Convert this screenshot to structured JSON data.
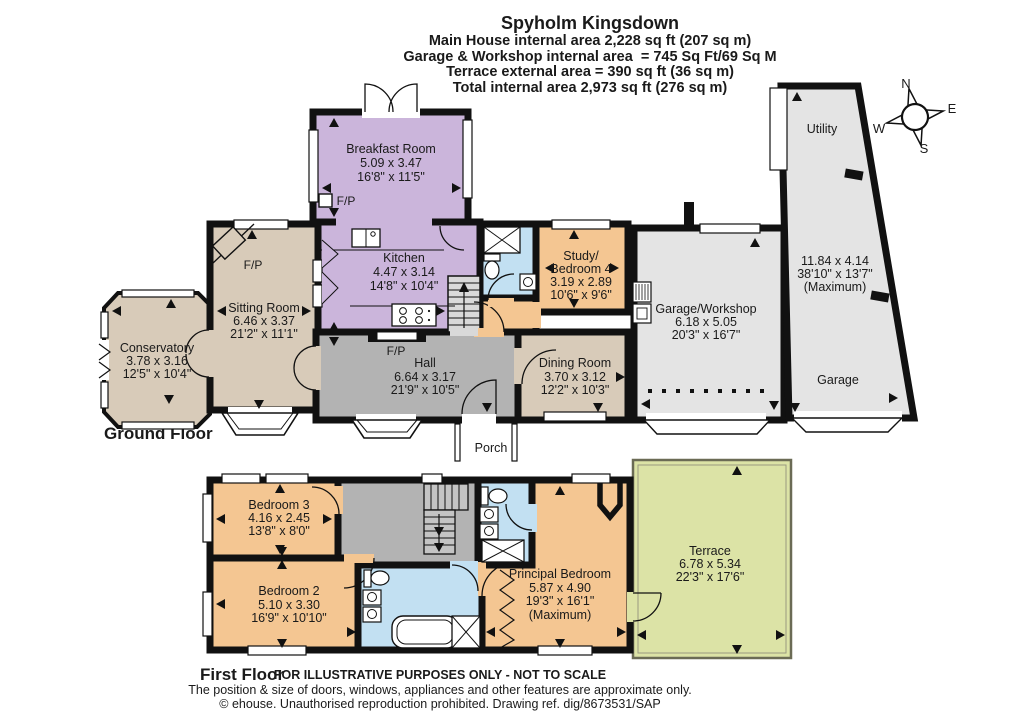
{
  "header": {
    "title": "Spyholm Kingsdown",
    "subtitle_lines": [
      "Main House internal area 2,228 sq ft (207 sq m)",
      "Garage & Workshop internal area  = 745 Sq Ft/69 Sq M",
      "Terrace external area = 390 sq ft (36 sq m)",
      "Total internal area 2,973 sq ft (276 sq m)"
    ]
  },
  "floor_labels": {
    "ground": "Ground Floor",
    "first": "First Floor"
  },
  "compass": {
    "north": "N",
    "east": "E",
    "south": "S",
    "west": "W"
  },
  "fireplace_label": "F/P",
  "rooms": {
    "breakfast_room": {
      "name": "Breakfast Room",
      "size_m": "5.09 x 3.47",
      "size_ft": "16'8\" x 11'5\""
    },
    "kitchen": {
      "name": "Kitchen",
      "size_m": "4.47 x 3.14",
      "size_ft": "14'8\" x 10'4\""
    },
    "study_bedroom4": {
      "name_line1": "Study/",
      "name_line2": "Bedroom 4",
      "size_m": "3.19 x 2.89",
      "size_ft": "10'6\" x 9'6\""
    },
    "sitting_room": {
      "name": "Sitting Room",
      "size_m": "6.46 x 3.37",
      "size_ft": "21'2\" x 11'1\""
    },
    "conservatory": {
      "name": "Conservatory",
      "size_m": "3.78 x 3.16",
      "size_ft": "12'5\" x 10'4\""
    },
    "hall": {
      "name": "Hall",
      "size_m": "6.64 x 3.17",
      "size_ft": "21'9\" x 10'5\""
    },
    "dining_room": {
      "name": "Dining Room",
      "size_m": "3.70 x 3.12",
      "size_ft": "12'2\" x 10'3\""
    },
    "garage_workshop": {
      "name": "Garage/Workshop",
      "size_m": "6.18 x 5.05",
      "size_ft": "20'3\" x 16'7\""
    },
    "utility": {
      "name": "Utility"
    },
    "garage": {
      "name": "Garage",
      "size_m": "11.84 x 4.14",
      "size_ft": "38'10\" x 13'7\"",
      "qualifier": "(Maximum)"
    },
    "porch": {
      "name": "Porch"
    },
    "bedroom3": {
      "name": "Bedroom 3",
      "size_m": "4.16 x 2.45",
      "size_ft": "13'8\" x 8'0\""
    },
    "bedroom2": {
      "name": "Bedroom 2",
      "size_m": "5.10 x 3.30",
      "size_ft": "16'9\" x 10'10\""
    },
    "principal_bedroom": {
      "name": "Principal Bedroom",
      "size_m": "5.87 x 4.90",
      "size_ft": "19'3\" x 16'1\"",
      "qualifier": "(Maximum)"
    },
    "terrace": {
      "name": "Terrace",
      "size_m": "6.78 x 5.34",
      "size_ft": "22'3\" x 17'6\""
    }
  },
  "footer": {
    "line1": "FOR ILLUSTRATIVE PURPOSES ONLY - NOT TO SCALE",
    "line2": "The position & size of doors, windows, appliances and other features are approximate only.",
    "line3": "© ehouse. Unauthorised reproduction prohibited. Drawing ref. dig/8673531/SAP"
  },
  "colors": {
    "wall": "#111111",
    "purple_room": "#cbb5db",
    "beige_room": "#d8cbb9",
    "gray_room": "#b3b3b3",
    "light_gray_room": "#e4e4e4",
    "orange_room": "#f4c692",
    "blue_room": "#c2e0f2",
    "green_terrace": "#dce3a6"
  }
}
